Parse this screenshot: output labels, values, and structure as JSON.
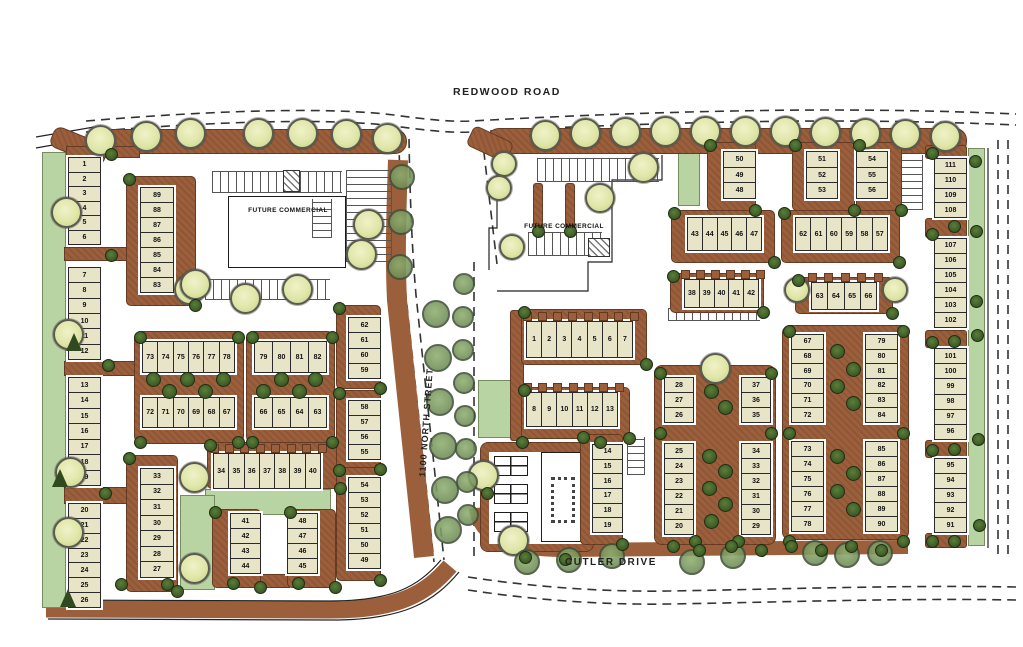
{
  "streets": {
    "top": "REDWOOD ROAD",
    "bottom": "CUTLER DRIVE",
    "middle": "1100 NORTH STREET"
  },
  "labels": {
    "future_commercial_west": "FUTURE COMMERCIAL",
    "future_commercial_east": "FUTURE COMMERCIAL"
  },
  "colors": {
    "lot_fill": "#e8e4c8",
    "hardscape_brown": "#9c5f3b",
    "green_light": "#b9d4a3",
    "tree_light": "#dfe6a8",
    "tree_dark": "#31491f",
    "tree_olive": "#647f4e",
    "outline": "#222222"
  },
  "west_parcel": {
    "lot_groups": [
      {
        "dir": "v",
        "x": 68,
        "y": 157,
        "w": 33,
        "h": 88,
        "lots": [
          "1",
          "2",
          "3",
          "4",
          "5",
          "6"
        ]
      },
      {
        "dir": "v",
        "x": 68,
        "y": 267,
        "w": 33,
        "h": 93,
        "lots": [
          "7",
          "8",
          "9",
          "10",
          "11",
          "12"
        ]
      },
      {
        "dir": "v",
        "x": 68,
        "y": 377,
        "w": 33,
        "h": 109,
        "lots": [
          "13",
          "14",
          "15",
          "16",
          "17",
          "18",
          "19"
        ]
      },
      {
        "dir": "v",
        "x": 68,
        "y": 503,
        "w": 33,
        "h": 105,
        "lots": [
          "20",
          "21",
          "22",
          "23",
          "24",
          "25",
          "26"
        ]
      },
      {
        "dir": "v",
        "x": 140,
        "y": 187,
        "w": 34,
        "h": 106,
        "lots": [
          "89",
          "88",
          "87",
          "86",
          "85",
          "84",
          "83"
        ],
        "frame": {
          "l": 14,
          "t": 11,
          "r": 22,
          "b": 13
        }
      },
      {
        "dir": "h",
        "x": 142,
        "y": 341,
        "w": 93,
        "h": 32,
        "lots": [
          "73",
          "74",
          "75",
          "76",
          "77",
          "78"
        ]
      },
      {
        "dir": "h",
        "x": 142,
        "y": 397,
        "w": 93,
        "h": 31,
        "lots": [
          "72",
          "71",
          "70",
          "69",
          "68",
          "67"
        ]
      },
      {
        "dir": "h",
        "x": 254,
        "y": 341,
        "w": 73,
        "h": 32,
        "lots": [
          "79",
          "80",
          "81",
          "82"
        ]
      },
      {
        "dir": "h",
        "x": 254,
        "y": 397,
        "w": 73,
        "h": 31,
        "lots": [
          "66",
          "65",
          "64",
          "63"
        ]
      },
      {
        "dir": "v",
        "x": 140,
        "y": 468,
        "w": 34,
        "h": 110,
        "lots": [
          "33",
          "32",
          "31",
          "30",
          "29",
          "28",
          "27"
        ],
        "frame": {
          "l": 14,
          "t": 13,
          "r": 4,
          "b": 14
        }
      },
      {
        "dir": "h",
        "x": 213,
        "y": 453,
        "w": 108,
        "h": 36,
        "lots": [
          "34",
          "35",
          "36",
          "37",
          "38",
          "39",
          "40"
        ],
        "frame": {
          "l": 6,
          "t": 11,
          "r": 20,
          "b": 0
        },
        "stubs": true
      },
      {
        "dir": "v",
        "x": 230,
        "y": 513,
        "w": 31,
        "h": 61,
        "lots": [
          "41",
          "42",
          "43",
          "44"
        ],
        "frame": {
          "l": 18,
          "t": 4,
          "r": 0,
          "b": 14
        }
      },
      {
        "dir": "v",
        "x": 287,
        "y": 513,
        "w": 31,
        "h": 61,
        "lots": [
          "48",
          "47",
          "46",
          "45"
        ],
        "frame": {
          "l": 0,
          "t": 4,
          "r": 18,
          "b": 14
        }
      },
      {
        "dir": "v",
        "x": 348,
        "y": 317,
        "w": 33,
        "h": 62,
        "lots": [
          "62",
          "61",
          "60",
          "59"
        ],
        "frame": {
          "l": 12,
          "t": 12,
          "r": 0,
          "b": 10
        }
      },
      {
        "dir": "v",
        "x": 348,
        "y": 400,
        "w": 33,
        "h": 60,
        "lots": [
          "58",
          "57",
          "56",
          "55"
        ],
        "frame": {
          "l": 12,
          "t": 10,
          "r": 0,
          "b": 10
        }
      },
      {
        "dir": "v",
        "x": 348,
        "y": 477,
        "w": 33,
        "h": 92,
        "lots": [
          "54",
          "53",
          "52",
          "51",
          "50",
          "49"
        ],
        "frame": {
          "l": 12,
          "t": 10,
          "r": 0,
          "b": 12
        }
      }
    ]
  },
  "east_parcel": {
    "lot_groups": [
      {
        "dir": "v",
        "x": 723,
        "y": 151,
        "w": 33,
        "h": 48,
        "lots": [
          "50",
          "49",
          "48"
        ],
        "frame": {
          "l": 16,
          "t": 9,
          "r": 0,
          "b": 12
        }
      },
      {
        "dir": "v",
        "x": 806,
        "y": 151,
        "w": 32,
        "h": 48,
        "lots": [
          "51",
          "52",
          "53"
        ],
        "frame": {
          "l": 14,
          "t": 9,
          "r": 17,
          "b": 12
        }
      },
      {
        "dir": "v",
        "x": 856,
        "y": 151,
        "w": 32,
        "h": 48,
        "lots": [
          "54",
          "55",
          "56"
        ],
        "frame": {
          "l": 0,
          "t": 9,
          "r": 14,
          "b": 12
        }
      },
      {
        "dir": "h",
        "x": 687,
        "y": 217,
        "w": 75,
        "h": 34,
        "lots": [
          "43",
          "44",
          "45",
          "46",
          "47"
        ],
        "frame": {
          "l": 16,
          "t": 7,
          "r": 13,
          "b": 12
        }
      },
      {
        "dir": "h",
        "x": 795,
        "y": 217,
        "w": 93,
        "h": 34,
        "lots": [
          "62",
          "61",
          "60",
          "59",
          "58",
          "57"
        ],
        "frame": {
          "l": 14,
          "t": 7,
          "r": 12,
          "b": 12
        }
      },
      {
        "dir": "h",
        "x": 684,
        "y": 279,
        "w": 75,
        "h": 29,
        "lots": [
          "38",
          "39",
          "40",
          "41",
          "42"
        ],
        "frame": {
          "l": 14,
          "t": 6,
          "r": 5,
          "b": 5
        },
        "stubs": true
      },
      {
        "dir": "h",
        "x": 811,
        "y": 282,
        "w": 66,
        "h": 28,
        "lots": [
          "63",
          "64",
          "65",
          "66"
        ],
        "frame": {
          "l": 16,
          "t": 5,
          "r": 16,
          "b": 4
        },
        "stubs": true
      },
      {
        "dir": "h",
        "x": 526,
        "y": 321,
        "w": 107,
        "h": 37,
        "lots": [
          "1",
          "2",
          "3",
          "4",
          "5",
          "6",
          "7"
        ],
        "frame": {
          "l": 5,
          "t": 12,
          "r": 14,
          "b": 7
        },
        "stubs": true
      },
      {
        "dir": "h",
        "x": 526,
        "y": 392,
        "w": 92,
        "h": 35,
        "lots": [
          "8",
          "9",
          "10",
          "11",
          "12",
          "13"
        ],
        "frame": {
          "l": 5,
          "t": 5,
          "r": 12,
          "b": 12
        },
        "stubs": true
      },
      {
        "dir": "v",
        "x": 592,
        "y": 444,
        "w": 31,
        "h": 89,
        "lots": [
          "14",
          "15",
          "16",
          "17",
          "18",
          "19"
        ],
        "frame": {
          "l": 12,
          "t": 10,
          "r": 0,
          "b": 12
        }
      },
      {
        "dir": "v",
        "x": 664,
        "y": 377,
        "w": 30,
        "h": 46,
        "lots": [
          "28",
          "27",
          "26"
        ]
      },
      {
        "dir": "v",
        "x": 664,
        "y": 443,
        "w": 30,
        "h": 92,
        "lots": [
          "25",
          "24",
          "23",
          "22",
          "21",
          "20"
        ]
      },
      {
        "dir": "v",
        "x": 741,
        "y": 377,
        "w": 30,
        "h": 46,
        "lots": [
          "37",
          "36",
          "35"
        ]
      },
      {
        "dir": "v",
        "x": 741,
        "y": 443,
        "w": 30,
        "h": 92,
        "lots": [
          "34",
          "33",
          "32",
          "31",
          "30",
          "29"
        ]
      },
      {
        "dir": "v",
        "x": 791,
        "y": 334,
        "w": 33,
        "h": 89,
        "lots": [
          "67",
          "68",
          "69",
          "70",
          "71",
          "72"
        ]
      },
      {
        "dir": "v",
        "x": 865,
        "y": 334,
        "w": 33,
        "h": 89,
        "lots": [
          "79",
          "80",
          "81",
          "82",
          "83",
          "84"
        ]
      },
      {
        "dir": "v",
        "x": 791,
        "y": 441,
        "w": 33,
        "h": 91,
        "lots": [
          "73",
          "74",
          "75",
          "76",
          "77",
          "78"
        ]
      },
      {
        "dir": "v",
        "x": 865,
        "y": 441,
        "w": 33,
        "h": 91,
        "lots": [
          "85",
          "86",
          "87",
          "88",
          "89",
          "90"
        ]
      },
      {
        "dir": "v",
        "x": 934,
        "y": 158,
        "w": 33,
        "h": 60,
        "lots": [
          "111",
          "110",
          "109",
          "108"
        ]
      },
      {
        "dir": "v",
        "x": 934,
        "y": 238,
        "w": 33,
        "h": 90,
        "lots": [
          "107",
          "106",
          "105",
          "104",
          "103",
          "102"
        ]
      },
      {
        "dir": "v",
        "x": 934,
        "y": 348,
        "w": 33,
        "h": 92,
        "lots": [
          "101",
          "100",
          "99",
          "98",
          "97",
          "96"
        ]
      },
      {
        "dir": "v",
        "x": 934,
        "y": 458,
        "w": 33,
        "h": 75,
        "lots": [
          "95",
          "94",
          "93",
          "92",
          "91"
        ]
      }
    ]
  }
}
